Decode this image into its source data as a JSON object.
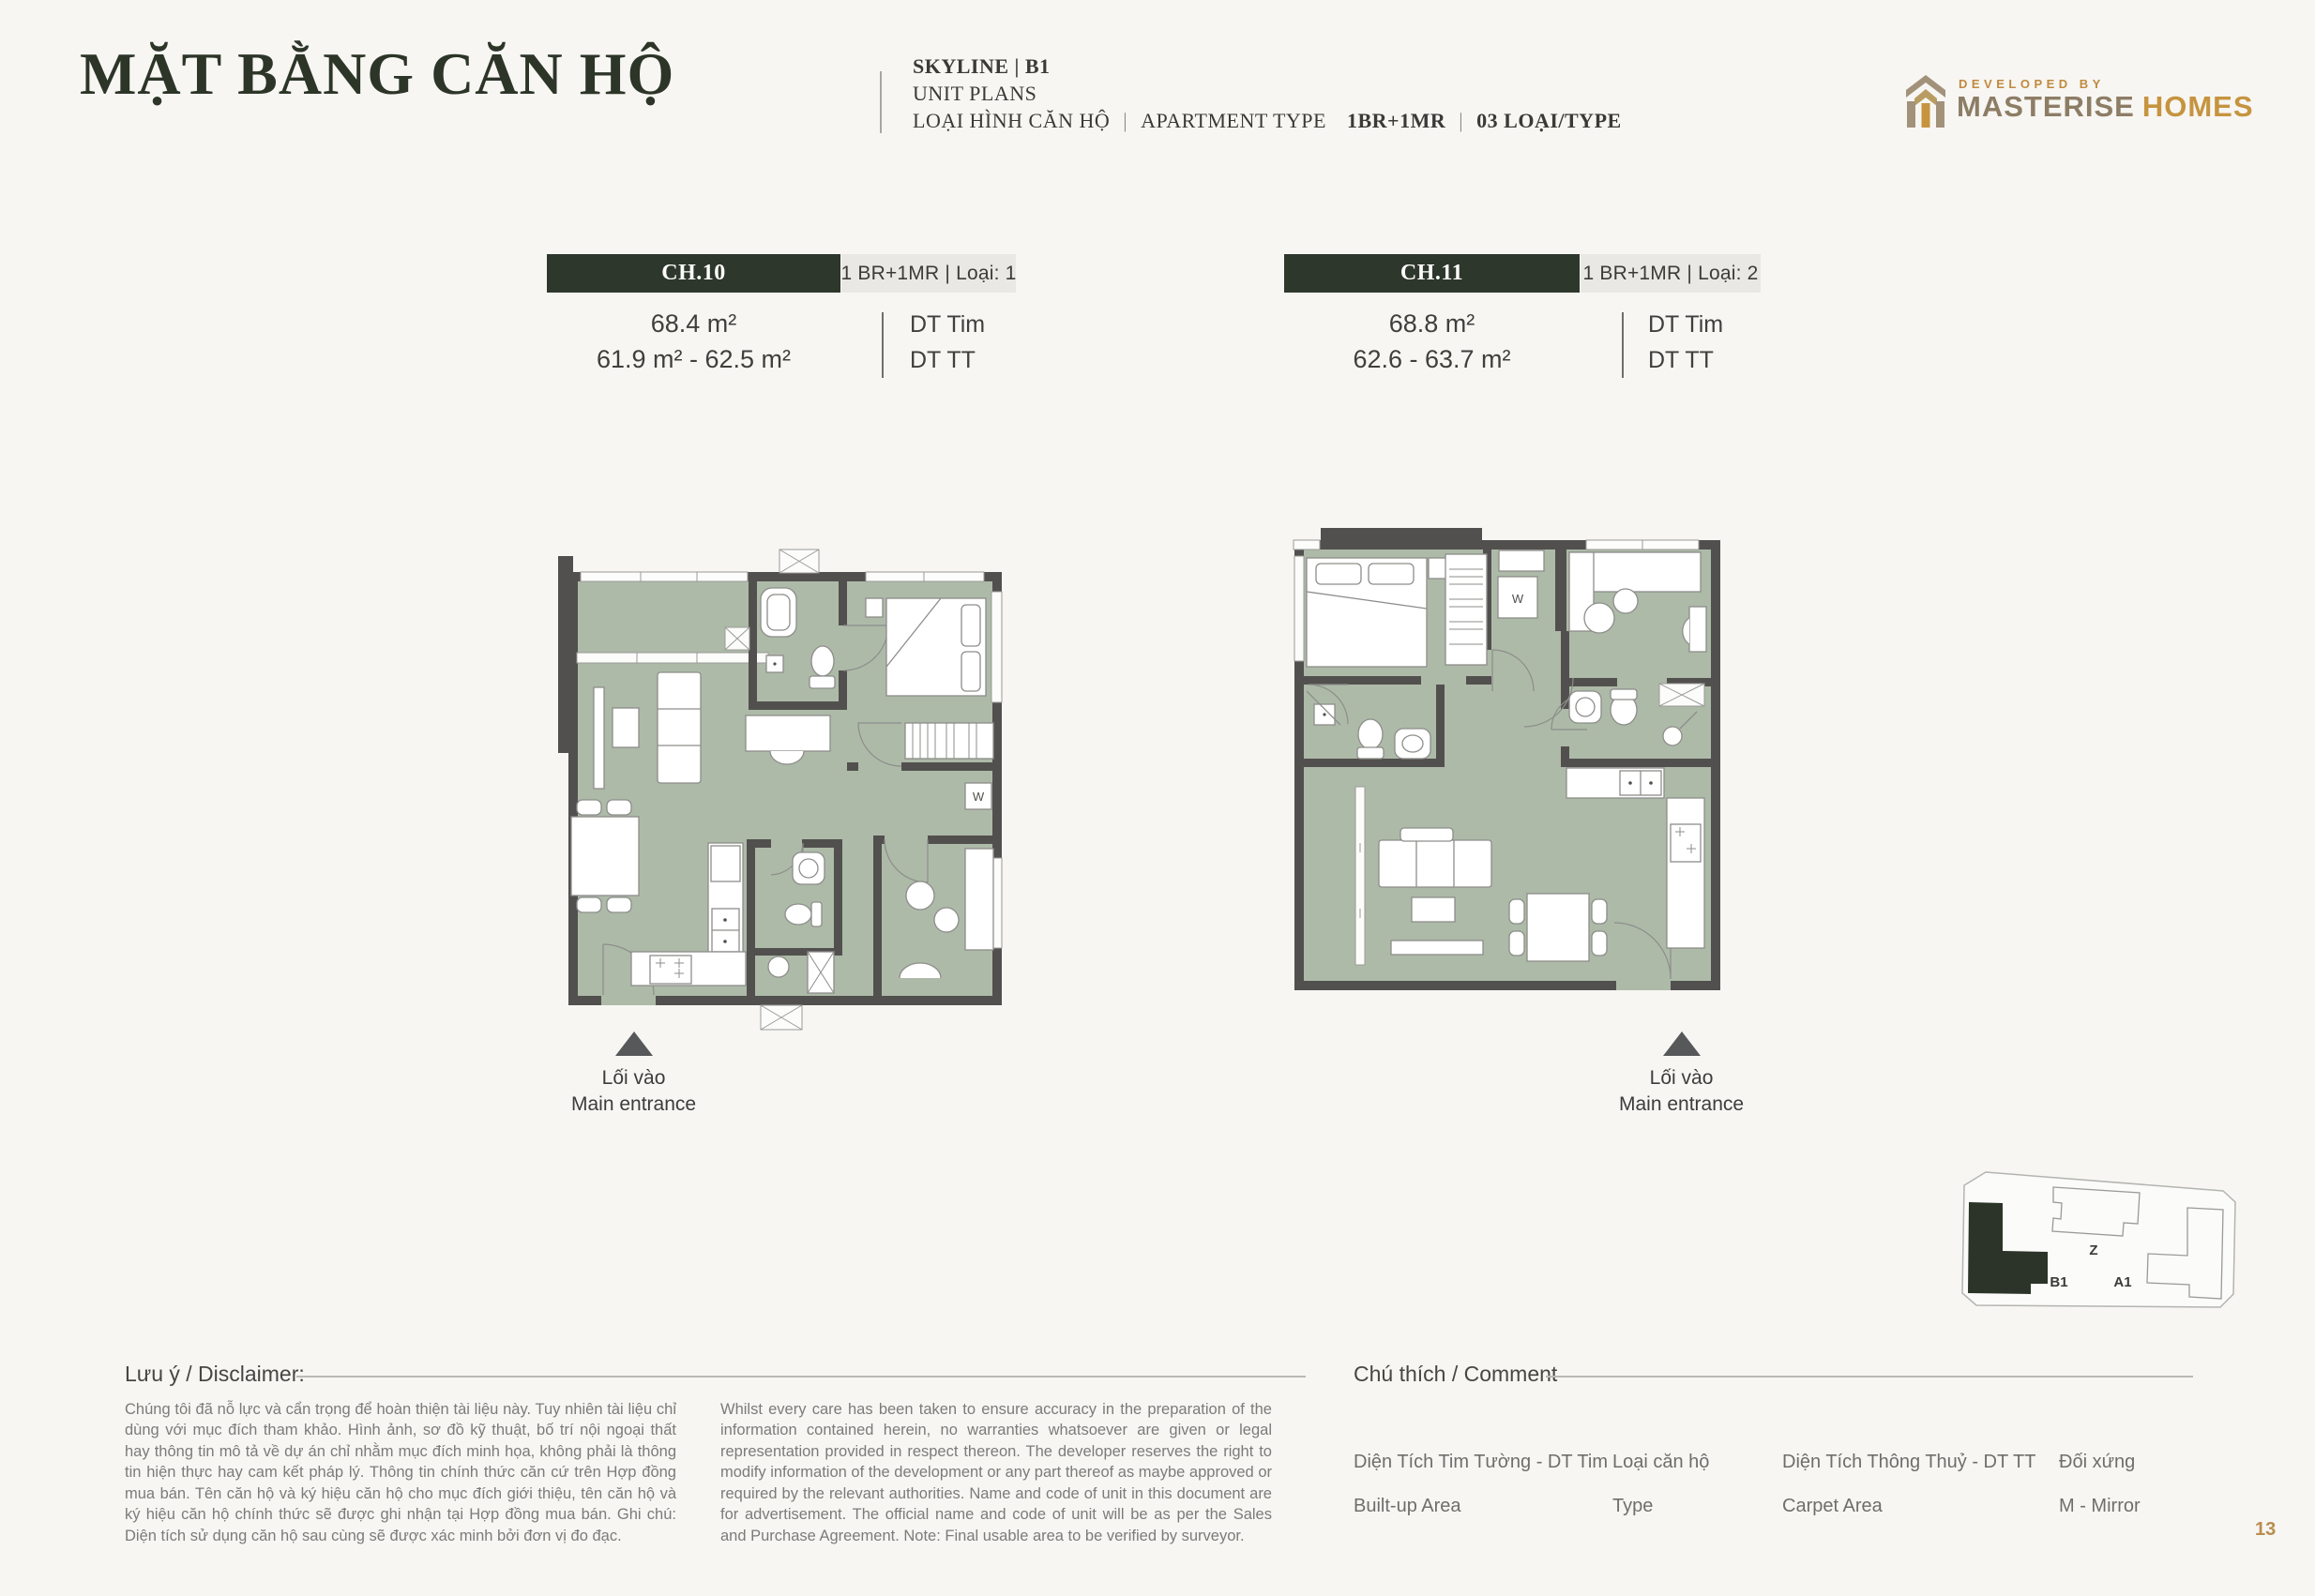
{
  "header": {
    "title": "MẶT BẰNG CĂN HỘ",
    "project": "SKYLINE | B1",
    "unit_plans": "UNIT PLANS",
    "type_label_vi": "LOẠI HÌNH CĂN HỘ",
    "sep": "|",
    "type_label_en": "APARTMENT TYPE",
    "type_value": "1BR+1MR",
    "type_count": "03 LOẠI/TYPE"
  },
  "developer": {
    "tagline": "DEVELOPED BY",
    "name_primary": "MASTERISE",
    "name_secondary": "HOMES"
  },
  "units": [
    {
      "code": "CH.10",
      "type": "1 BR+1MR | Loại: 1",
      "area_builtup": "68.4 m²",
      "area_carpet": "61.9 m² - 62.5 m²",
      "label_builtup": "DT Tim",
      "label_carpet": "DT TT",
      "entrance_vi": "Lối vào",
      "entrance_en": "Main entrance"
    },
    {
      "code": "CH.11",
      "type": "1 BR+1MR | Loại: 2",
      "area_builtup": "68.8 m²",
      "area_carpet": "62.6 - 63.7 m²",
      "label_builtup": "DT Tim",
      "label_carpet": "DT TT",
      "entrance_vi": "Lối vào",
      "entrance_en": "Main entrance"
    }
  ],
  "plans": {
    "washer_label": "W"
  },
  "site_plan": {
    "label_z": "Z",
    "label_b1": "B1",
    "label_a1": "A1"
  },
  "disclaimer": {
    "heading": "Lưu ý / Disclaimer:",
    "body_vi": "Chúng tôi đã nỗ lực và cẩn trọng để hoàn thiện tài liệu này. Tuy nhiên tài liệu chỉ dùng với mục đích tham khảo. Hình ảnh, sơ đồ kỹ thuật, bố trí nội ngoại thất hay thông tin mô tả về dự án chỉ nhằm mục đích minh họa, không phải là thông tin hiện thực hay cam kết pháp lý. Thông tin chính thức căn cứ trên Hợp đồng mua bán. Tên căn hộ và ký hiệu căn hộ cho mục đích giới thiệu, tên căn hộ và ký hiệu căn hộ chính thức sẽ được ghi nhận tại Hợp đồng mua bán. Ghi chú: Diện tích sử dụng căn hộ sau cùng sẽ được xác minh bởi đơn vị đo đạc.",
    "body_en": "Whilst every care has been taken to ensure accuracy in the preparation of the information contained herein, no warranties whatsoever are given or legal representation provided in respect thereon. The developer reserves the right to modify information of the development or any part thereof as maybe approved or required by the relevant authorities. Name and code of unit in this document are for advertisement. The official name and code of unit will be as per the Sales and Purchase Agreement. Note: Final usable area to be verified by surveyor."
  },
  "legend": {
    "heading": "Chú thích / Comment",
    "items": [
      {
        "line1": "Diện Tích Tim Tường - DT Tim",
        "line2": "Built-up Area"
      },
      {
        "line1": "Loại căn hộ",
        "line2": "Type"
      },
      {
        "line1": "Diện Tích Thông Thuỷ - DT TT",
        "line2": "Carpet Area"
      },
      {
        "line1": "Đối xứng",
        "line2": "M - Mirror"
      }
    ]
  },
  "page_number": "13",
  "colors": {
    "background": "#f7f6f3",
    "accent_green": "#2e372b",
    "floor_sage": "#adbaa8",
    "wall_gray": "#52504e",
    "gold": "#c6943f",
    "taupe": "#8d7d65"
  }
}
